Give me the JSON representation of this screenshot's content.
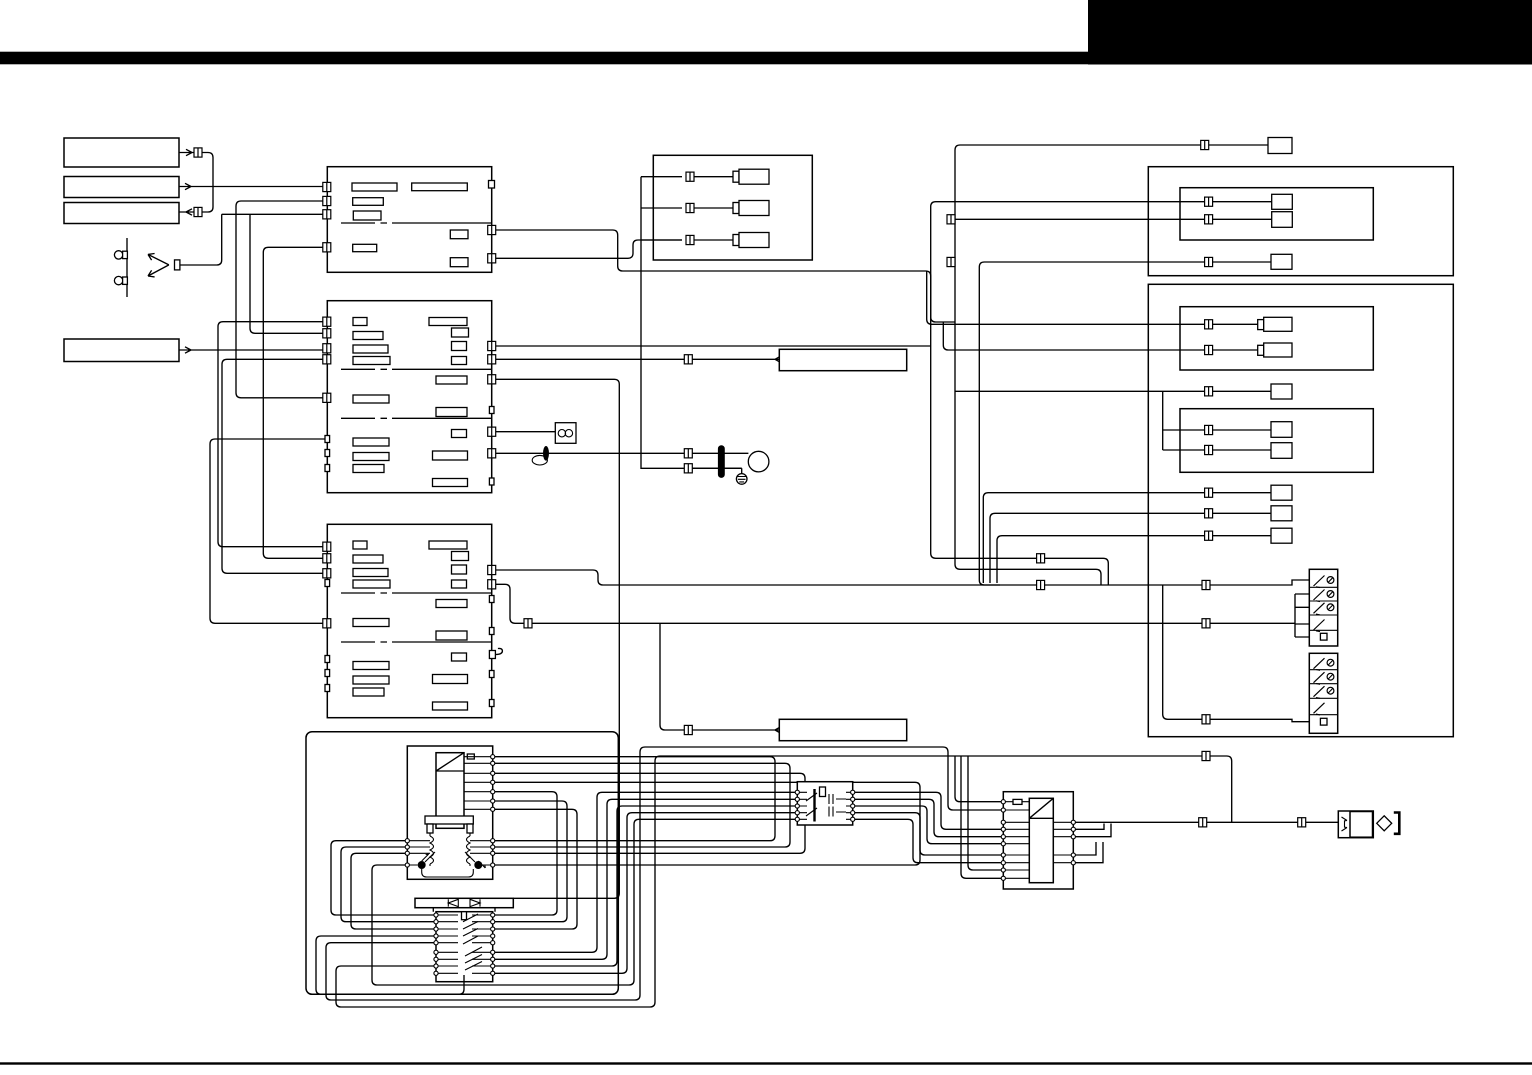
{
  "page": {
    "type": "service-manual wiring schematic page",
    "title_text": ""
  },
  "colors": {
    "ink": "#000000",
    "paper": "#ffffff"
  },
  "header": {
    "top_bar_label": "",
    "corner_block_label": ""
  },
  "inventory": {
    "left_source_boxes": [
      "",
      "",
      "",
      ""
    ],
    "callout_label_boxes": [
      "",
      ""
    ],
    "circuit_boards": 3,
    "relay_box_rows": 3,
    "right_panel_units": 2,
    "right_unit_component_rows": 11,
    "switch_bank_rows": 10,
    "transformer_windings": 2
  },
  "icons": {
    "wire_connector": "double-square",
    "pin": "small-circle",
    "ground": "hatched-circle",
    "motor": "circle",
    "ferrite_bead": "filled-ellipse",
    "noise_filter": "box-with-two-circles",
    "diode_pair": "dual-triangle-bar",
    "output_plug": "diamond-bracket",
    "arrow": "v-head"
  }
}
